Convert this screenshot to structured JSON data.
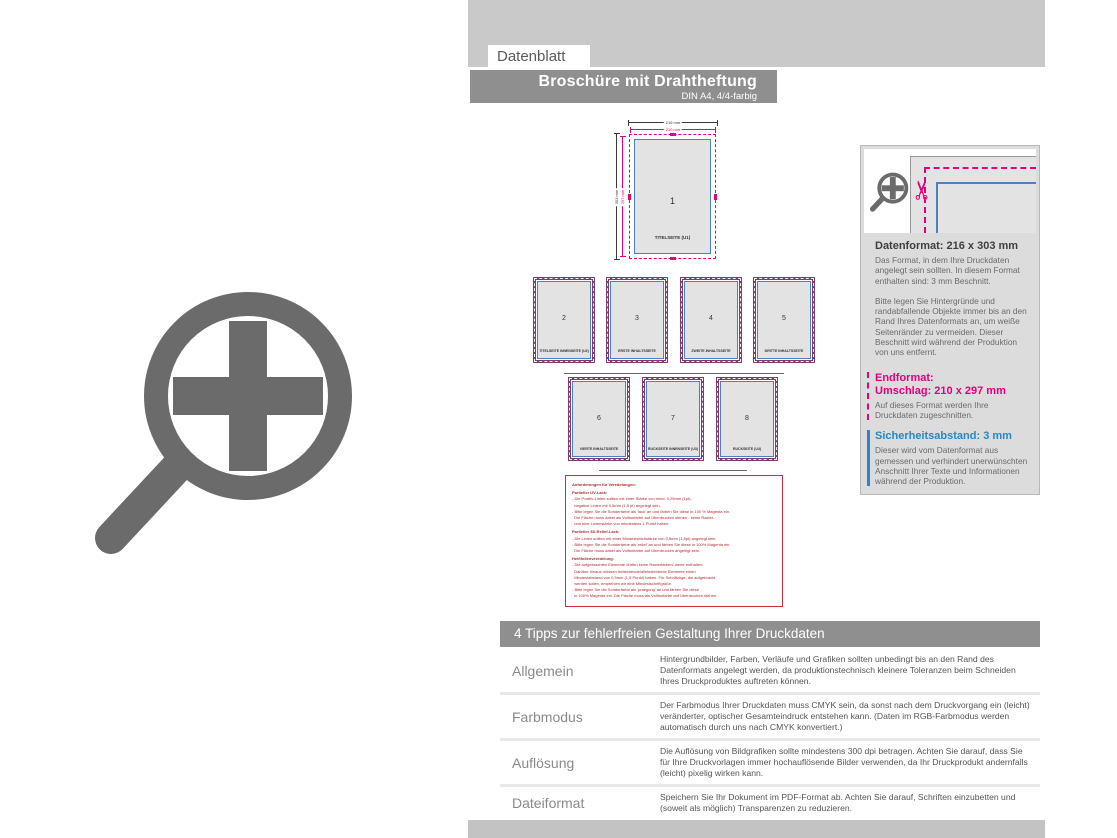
{
  "header": {
    "tab_label": "Datenblatt",
    "title": "Broschüre mit Drahtheftung",
    "subtitle": "DIN A4, 4/4-farbig"
  },
  "diagram": {
    "dim_width_outer": "216 mm",
    "dim_width_inner": "210 mm",
    "dim_height_outer": "303 mm",
    "dim_height_inner": "297 mm",
    "title_page": {
      "number": "1",
      "caption": "TITELSEITE (U1)"
    },
    "pages": [
      {
        "number": "2",
        "caption": "TITELSEITE INNENSEITE (U2)"
      },
      {
        "number": "3",
        "caption": "ERSTE INHALTSSEITE"
      },
      {
        "number": "4",
        "caption": "ZWEITE INHALTSSEITE"
      },
      {
        "number": "5",
        "caption": "DRITTE INHALTSSEITE"
      },
      {
        "number": "6",
        "caption": "VIERTE INHALTSSEITE"
      },
      {
        "number": "7",
        "caption": "RÜCKSEITE INNENSEITE (U3)"
      },
      {
        "number": "8",
        "caption": "RÜCKSEITE (U4)"
      }
    ]
  },
  "notes": {
    "lines": [
      {
        "bold": true,
        "text": "Anforderungen für Veredelungen:"
      },
      {
        "bold": true,
        "text": "Partieller UV-Lack:"
      },
      {
        "bold": false,
        "text": "- Die Positiv-Linien sollten mit einer Stärke von mind. 0,25mm (1pt),"
      },
      {
        "bold": false,
        "text": "  negative Linien mit 0,5mm (1,5 pt) angelegt sein."
      },
      {
        "bold": false,
        "text": "- Bitte legen Sie die Sonderfarbe als 'lack' an und färben Sie diese in 100 % Magenta ein."
      },
      {
        "bold": false,
        "text": "  Die Fläche muss dabei als Volltonfarbe auf Überdrucken stehen - keine Raster-"
      },
      {
        "bold": false,
        "text": "  und eine Linienstärke von mindestens 1 Punkt haben."
      },
      {
        "bold": true,
        "text": "Partieller 3D-Relief-Lack:"
      },
      {
        "bold": false,
        "text": "- Die Linien sollten mit einer Mindeststrichstärke von 0,5mm (1,5pt) angelegt sein."
      },
      {
        "bold": false,
        "text": "- Bitte legen Sie die Sonderfarbe als 'relief' an und färben Sie diese in 100% Magenta ein."
      },
      {
        "bold": false,
        "text": "  Die Fläche muss dabei als Volltonfarbe auf Überdrucken angelegt sein."
      },
      {
        "bold": true,
        "text": "Heißfolienveredelung:"
      },
      {
        "bold": false,
        "text": "- Die aufgebrachten Elemente dürfen keine Rasterfarben/-werte enthalten."
      },
      {
        "bold": false,
        "text": "  Darüber hinaus müssen freistehende/alleinstehende Elemente einen"
      },
      {
        "bold": false,
        "text": "  Mindestabstand von 0,5mm (1,5 Punkt) haben. Für Schriftzüge, die aufgebracht"
      },
      {
        "bold": false,
        "text": "  werden sollen, empfehlen wir eine Mindestschriftgröße."
      },
      {
        "bold": false,
        "text": "- Bitte legen Sie die Sonderfarbe als 'praegung' an und färben Sie diese"
      },
      {
        "bold": false,
        "text": "  in 100% Magenta ein. Die Fläche muss als Volltonfarbe auf Überdrucken stehen."
      }
    ]
  },
  "info_panel": {
    "datenformat_title": "Datenformat: 216 x 303 mm",
    "datenformat_body1": "Das Format, in dem Ihre Druckdaten angelegt sein sollten. In diesem Format enthalten sind: 3 mm Beschnitt.",
    "datenformat_body2": "Bitte legen Sie Hintergründe und randabfallende Objekte immer bis an den Rand Ihres Datenformats an, um weiße Seitenränder zu vermeiden. Dieser Beschnitt wird während der Produktion von uns entfernt.",
    "endformat_title1": "Endformat:",
    "endformat_title2": "Umschlag: 210 x 297 mm",
    "endformat_body": "Auf dieses Format werden Ihre Druckdaten zugeschnitten.",
    "sicherheit_title": "Sicherheitsabstand: 3 mm",
    "sicherheit_body": "Dieser wird vom Datenformat aus gemessen und verhindert unerwünschten Anschnitt Ihrer Texte und Informationen während der Produktion."
  },
  "tips": {
    "title": "4 Tipps zur fehlerfreien Gestaltung Ihrer Druckdaten",
    "rows": [
      {
        "label": "Allgemein",
        "text": "Hintergrundbilder, Farben, Verläufe und Grafiken sollten unbedingt bis an den Rand des Datenformats angelegt werden, da produktionstechnisch kleinere Toleranzen beim Schneiden Ihres Druckproduktes auftreten können."
      },
      {
        "label": "Farbmodus",
        "text": "Der Farbmodus Ihrer Druckdaten muss CMYK sein, da sonst nach dem Druckvorgang ein (leicht) veränderter, optischer Gesamteindruck entstehen kann. (Daten im RGB-Farbmodus werden automatisch durch uns nach CMYK konvertiert.)"
      },
      {
        "label": "Auflösung",
        "text": "Die Auflösung von Bildgrafiken sollte mindestens 300 dpi betragen. Achten Sie darauf, dass Sie für Ihre Druckvorlagen immer hochauflösende Bilder verwenden, da Ihr Druckprodukt andernfalls (leicht) pixelig wirken kann."
      },
      {
        "label": "Dateiformat",
        "text": "Speichern Sie Ihr Dokument im PDF-Format ab. Achten Sie darauf, Schriften einzubetten und (soweit als möglich) Transparenzen zu reduzieren."
      }
    ]
  },
  "icons": {
    "zoom_plus_icon": "magnifier-with-plus",
    "scissors_icon": "✂"
  },
  "colors": {
    "magenta": "#e5007d",
    "blue_heading": "#2787c8",
    "blue_line": "#4a81c0",
    "purple_border": "#7e3c70",
    "red_notes": "#b02a35",
    "bar_dark": "#8f8f8f",
    "bar_light": "#c9c9c9",
    "icon_gray": "#6b6b6b",
    "page_fill": "#e3e3e3"
  }
}
